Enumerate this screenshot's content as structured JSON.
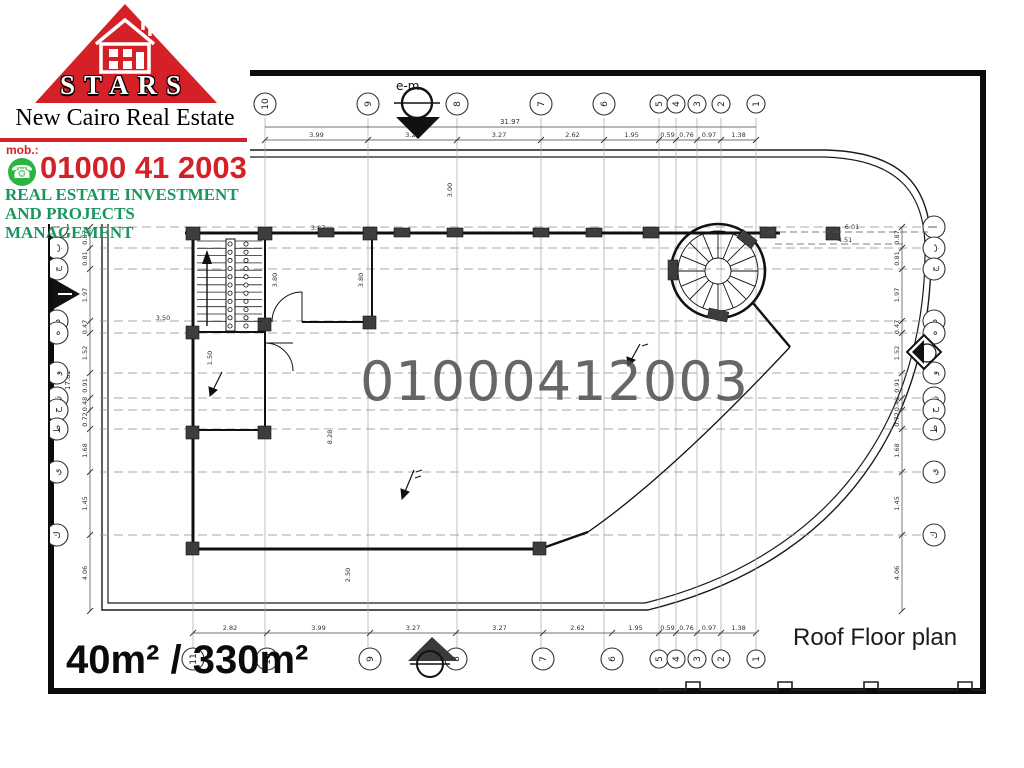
{
  "branding": {
    "company": "STARS",
    "tagline": "New Cairo Real Estate",
    "mobile_label": "mob.:",
    "phone": "01000 41 2003",
    "subtitle_line1": "REAL ESTATE INVESTMENT",
    "subtitle_line2": "AND PROJECTS MANAGEMENT",
    "colors": {
      "red": "#d42127",
      "green": "#18965e",
      "whatsapp_green": "#2ab540"
    }
  },
  "plan": {
    "watermark": "01000412003",
    "title": "Roof Floor plan",
    "area_label": "40m² / 330m²",
    "north_label": "e-m",
    "grid": {
      "top_labels": [
        "10",
        "9",
        "8",
        "7",
        "6",
        "5",
        "4",
        "3",
        "2",
        "1"
      ],
      "bottom_labels": [
        "11",
        "10",
        "9",
        "8",
        "7",
        "6",
        "5",
        "4",
        "3",
        "2",
        "1"
      ],
      "left_labels": [
        "أ",
        "ب",
        "ج",
        "د",
        "ه",
        "و",
        "ز",
        "ح",
        "ط",
        "ي",
        "ك"
      ],
      "right_labels": [
        "أ",
        "ب",
        "ج",
        "د",
        "ه",
        "و",
        "ز",
        "ح",
        "ط",
        "ي",
        "ك"
      ]
    },
    "dimensions": {
      "top": [
        "3.99",
        "3.27",
        "3.27",
        "2.62",
        "1.95",
        "0.59",
        "0.76",
        "0.97",
        "1.38"
      ],
      "top_overall": "31.97",
      "bottom": [
        "2.82",
        "3.99",
        "3.27",
        "3.27",
        "2.62",
        "1.95",
        "0.59",
        "0.76",
        "0.97",
        "1.38"
      ],
      "left": [
        "0.87",
        "0.81",
        "1.97",
        "0.47",
        "1.52",
        "0.91",
        "0.48",
        "0.72",
        "1.68",
        "1.45",
        "4.06"
      ],
      "left_overall": "17.82",
      "right": [
        "0.87",
        "0.81",
        "1.97",
        "0.47",
        "1.52",
        "0.91",
        "0.48",
        "0.72",
        "1.68",
        "1.45",
        "4.06"
      ],
      "interior": [
        "3.87",
        "3.80",
        "3.80",
        "1.50",
        "3.00",
        "3.50",
        "2.50",
        "8.28",
        "6.01",
        "4.51"
      ]
    }
  }
}
